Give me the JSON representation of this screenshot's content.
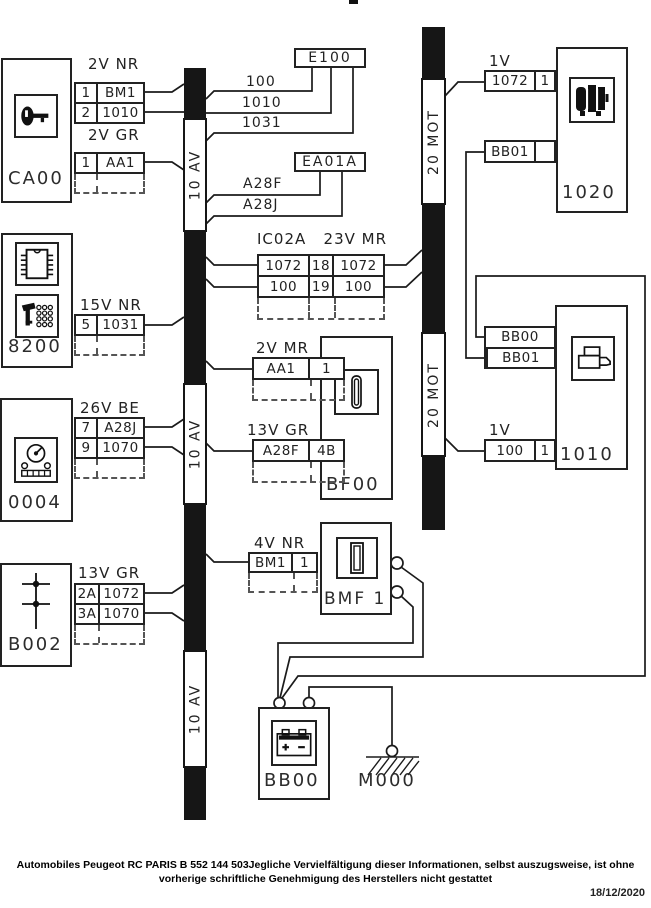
{
  "buses": {
    "av": "10 AV",
    "mot": "20 MOT"
  },
  "components": {
    "ca00": "CA00",
    "c8200": "8200",
    "c0004": "0004",
    "b002": "B002",
    "bf00": "BF00",
    "bmf1": "BMF 1",
    "u1020": "1020",
    "u1010": "1010",
    "bb00": "BB00",
    "m000": "M000"
  },
  "nodes": {
    "e100": "E100",
    "ea01a": "EA01A"
  },
  "conn": {
    "ca00_a": {
      "title": "2V NR",
      "r1c1": "1",
      "r1c2": "BM1",
      "r2c1": "2",
      "r2c2": "1010"
    },
    "ca00_b": {
      "title": "2V GR",
      "r1c1": "1",
      "r1c2": "AA1"
    },
    "s8200": {
      "title": "15V NR",
      "r1c1": "5",
      "r1c2": "1031"
    },
    "s0004": {
      "title": "26V BE",
      "r1c1": "7",
      "r1c2": "A28J",
      "r2c1": "9",
      "r2c2": "1070"
    },
    "b002": {
      "title": "13V GR",
      "r1c1": "2A",
      "r1c2": "1072",
      "r2c1": "3A",
      "r2c2": "1070"
    },
    "bf00_a": {
      "title": "2V MR",
      "r1c1": "AA1",
      "r1c2": "1"
    },
    "bf00_b": {
      "title": "13V GR",
      "r1c1": "A28F",
      "r1c2": "4B"
    },
    "bmf1": {
      "title": "4V NR",
      "r1c1": "BM1",
      "r1c2": "1"
    },
    "mot_top": {
      "title": "1V",
      "r1c1": "1072",
      "r1c2": "1"
    },
    "bb01_1020": {
      "r1c1": "BB01"
    },
    "bb_1010": {
      "r1": "BB00",
      "r2": "BB01"
    },
    "mot_bot": {
      "title": "1V",
      "r1c1": "100",
      "r1c2": "1"
    }
  },
  "ic02a": {
    "title": "IC02A   23V MR",
    "r1c1": "1072",
    "r1c2": "18",
    "r1c3": "1072",
    "r2c1": "100",
    "r2c2": "19",
    "r2c3": "100"
  },
  "wire_labels": {
    "w100": "100",
    "w1010": "1010",
    "w1031": "1031",
    "a28f": "A28F",
    "a28j": "A28J"
  },
  "footer": {
    "line1": "Automobiles Peugeot RC PARIS B 552 144 503Jegliche Vervielfältigung dieser Informationen, selbst auszugsweise, ist ohne",
    "line2": "vorherige schriftliche Genehmigung des Herstellers nicht gestattet",
    "date": "18/12/2020"
  }
}
